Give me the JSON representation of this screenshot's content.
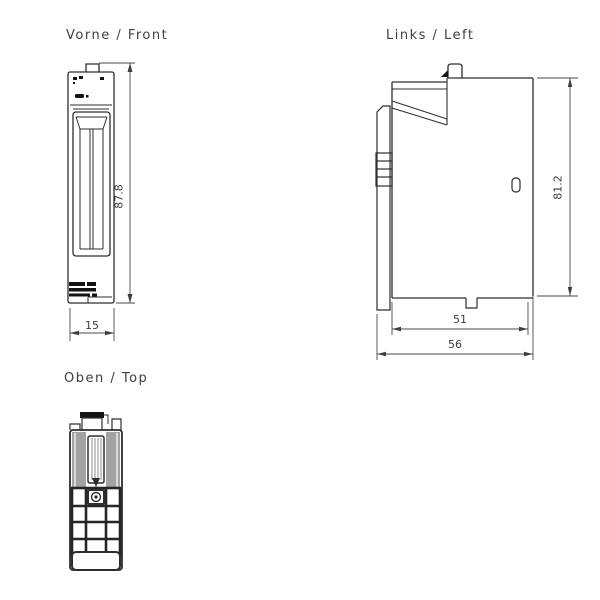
{
  "views": {
    "front": {
      "title": "Vorne / Front",
      "height_dim": "87.8",
      "width_dim": "15"
    },
    "left": {
      "title": "Links / Left",
      "height_dim": "81.2",
      "depth_inner_dim": "51",
      "depth_dim": "56"
    },
    "top": {
      "title": "Oben / Top"
    }
  },
  "colors": {
    "line": "#2e2e2e",
    "dimension_line": "#4a4a4a",
    "text": "#3f3f3f",
    "shade_gray": "#a3a3a3",
    "background": "#ffffff"
  }
}
